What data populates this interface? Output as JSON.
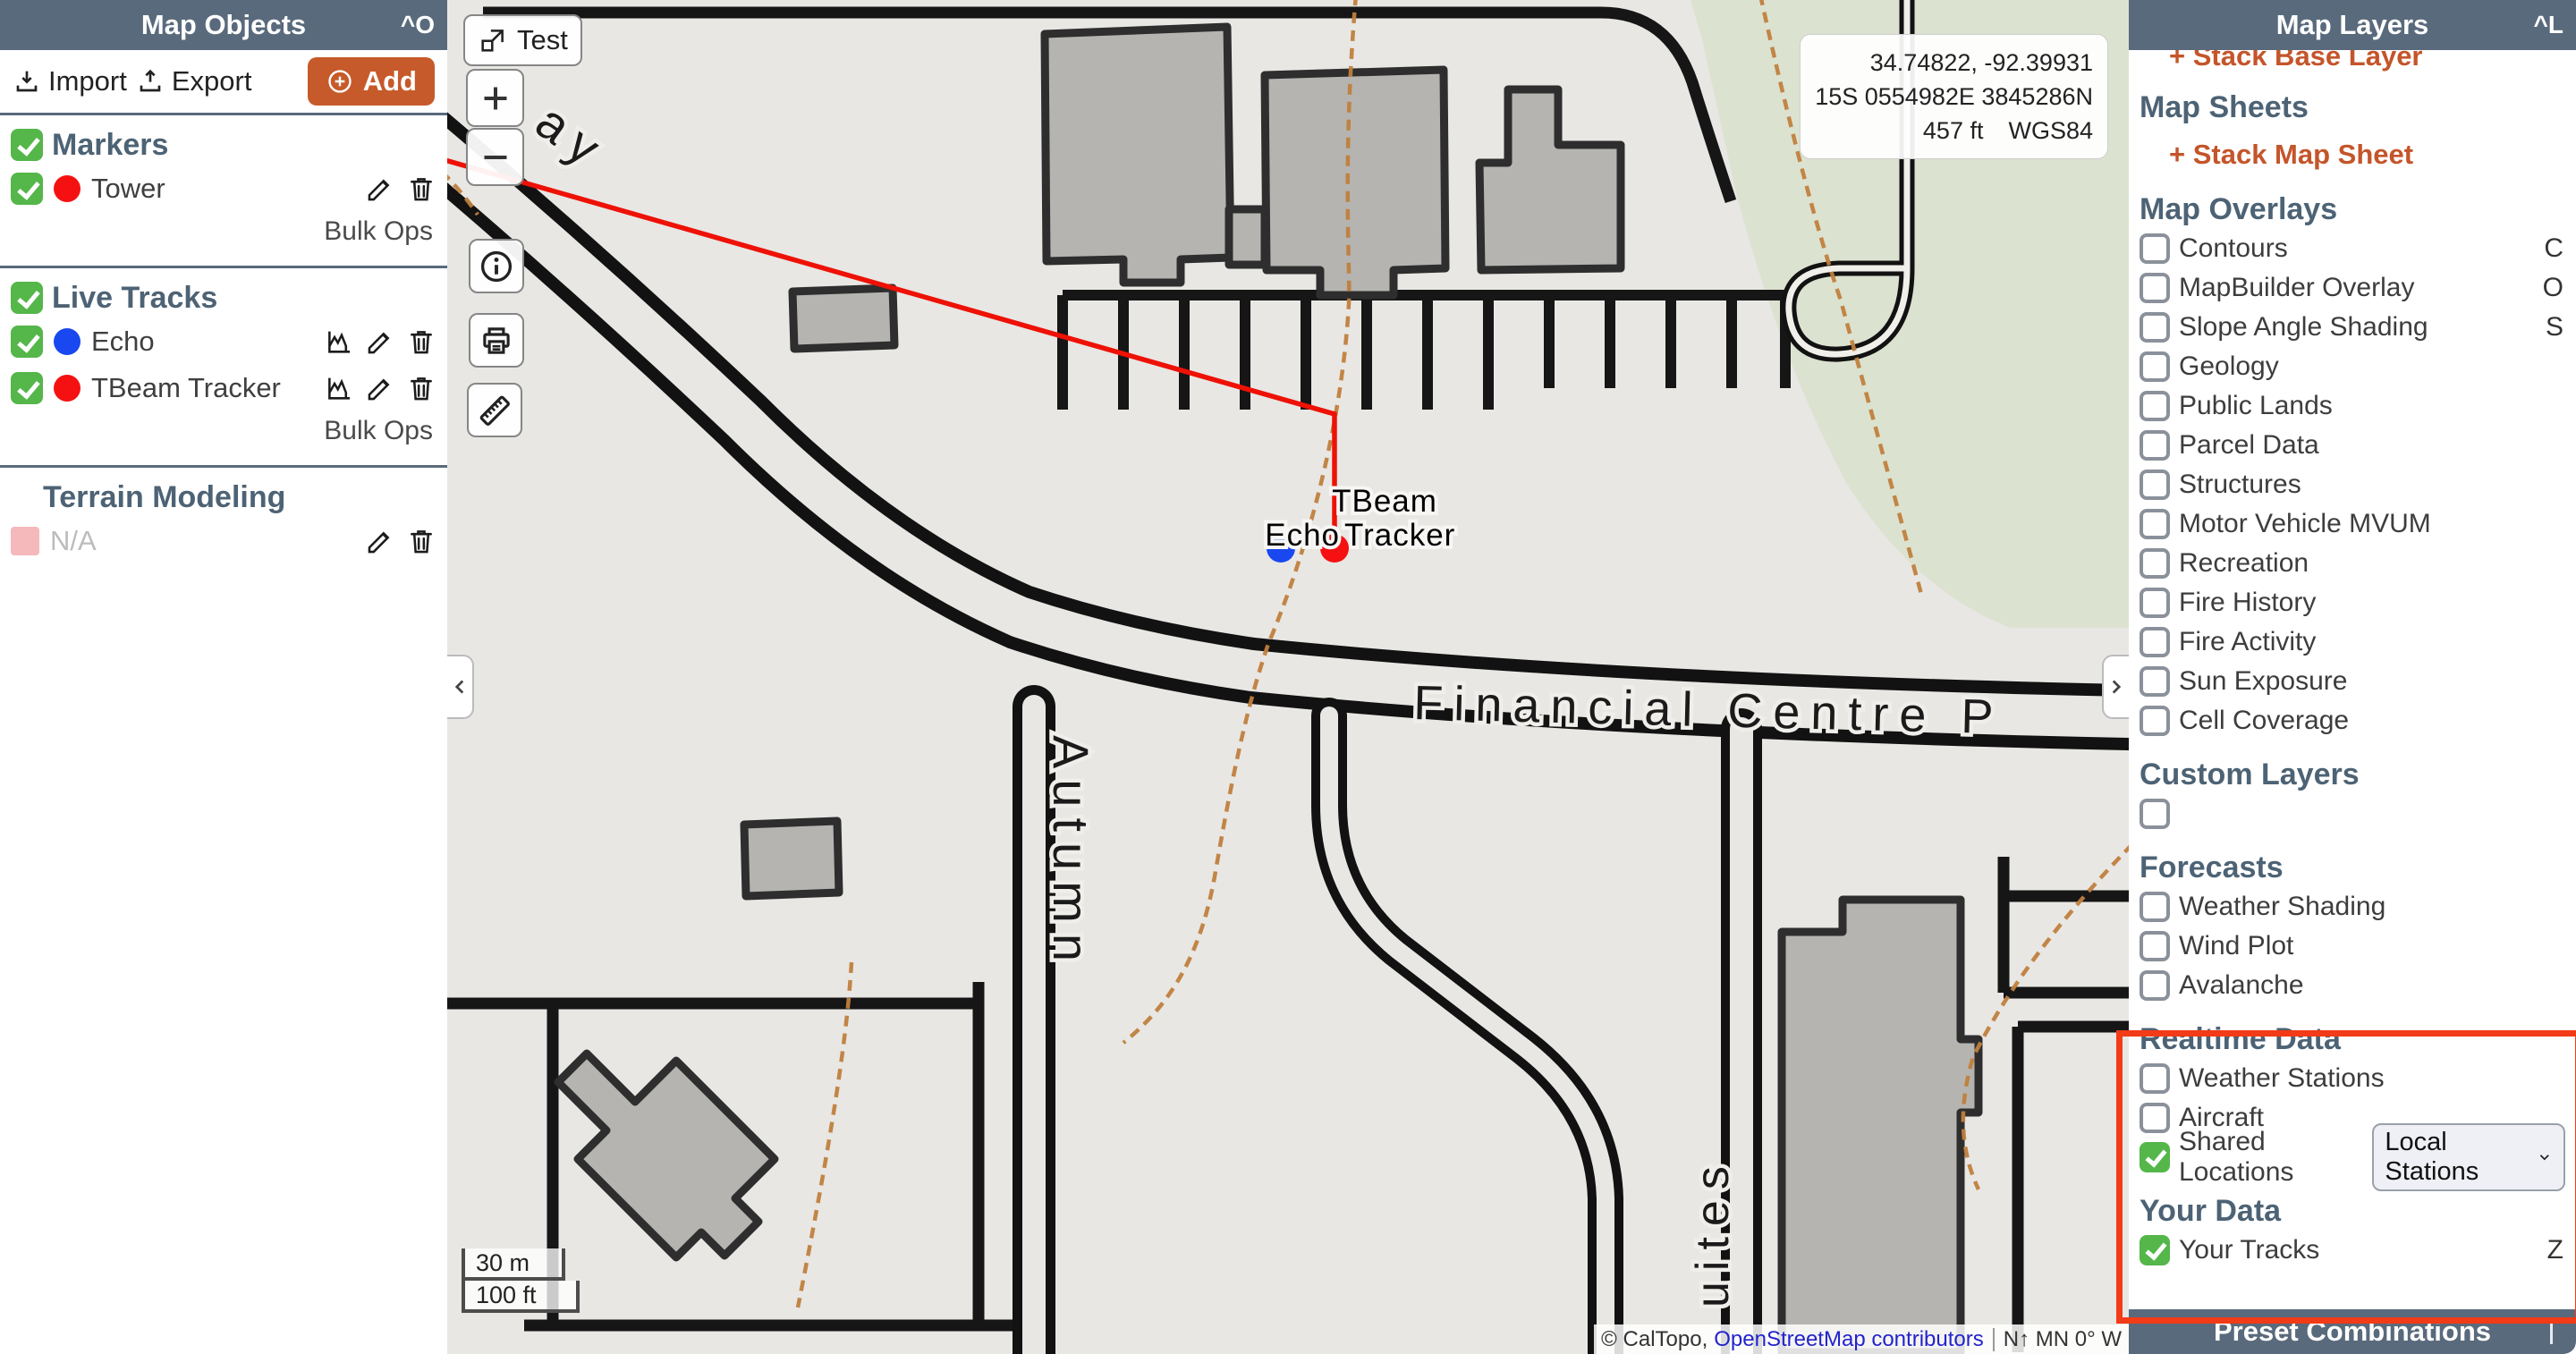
{
  "colors": {
    "header_slate": "#596a7c",
    "heading_slate": "#4d6375",
    "accent_orange": "#c65a2a",
    "checkbox_green": "#55b64a",
    "marker_red": "#f51111",
    "marker_blue": "#1948f0",
    "track_red": "#ee1105",
    "highlight_red": "#f23b17",
    "contour_orange": "#c0803d"
  },
  "left_panel": {
    "title": "Map Objects",
    "shortcut": "^O",
    "toolbar": {
      "import": "Import",
      "export": "Export",
      "add": "Add"
    },
    "sections": {
      "markers": {
        "label": "Markers",
        "items": [
          {
            "label": "Tower",
            "color": "#f51111",
            "checked": true
          }
        ],
        "bulk_ops": "Bulk Ops"
      },
      "live_tracks": {
        "label": "Live Tracks",
        "items": [
          {
            "label": "Echo",
            "color": "#1948f0",
            "checked": true
          },
          {
            "label": "TBeam Tracker",
            "color": "#f51111",
            "checked": true
          }
        ],
        "bulk_ops": "Bulk Ops"
      },
      "terrain": {
        "label": "Terrain Modeling",
        "items": [
          {
            "label": "N/A",
            "color": "#f5b8bb",
            "checked": false
          }
        ]
      }
    }
  },
  "map": {
    "test_button": "Test",
    "coordinates": {
      "latlon": "34.74822, -92.39931",
      "utm": "15S 0554982E 3845286N",
      "elevation": "457 ft",
      "datum": "WGS84"
    },
    "scale": {
      "metric": "30 m",
      "imperial": "100 ft"
    },
    "attribution": {
      "caltopo": "© CalTopo,",
      "osm": "OpenStreetMap contributors",
      "compass": "N↑ MN 0° W"
    },
    "street_labels": {
      "financial": "Financial Centre P",
      "autumn": "Autumn",
      "suites": "uites",
      "way": "ay"
    },
    "marker_labels": {
      "tbeam_line1": "TBeam",
      "tbeam_line2": "Tracker",
      "echo": "Echo"
    }
  },
  "right_panel": {
    "title": "Map Layers",
    "shortcut": "^L",
    "stack_base_layer": "+ Stack Base Layer",
    "map_sheets": {
      "heading": "Map Sheets",
      "stack_link": "+ Stack Map Sheet"
    },
    "map_overlays": {
      "heading": "Map Overlays",
      "items": [
        {
          "label": "Contours",
          "shortcut": "C",
          "checked": false
        },
        {
          "label": "MapBuilder Overlay",
          "shortcut": "O",
          "checked": false
        },
        {
          "label": "Slope Angle Shading",
          "shortcut": "S",
          "checked": false
        },
        {
          "label": "Geology",
          "checked": false
        },
        {
          "label": "Public Lands",
          "checked": false
        },
        {
          "label": "Parcel Data",
          "checked": false
        },
        {
          "label": "Structures",
          "checked": false
        },
        {
          "label": "Motor Vehicle MVUM",
          "checked": false
        },
        {
          "label": "Recreation",
          "checked": false
        },
        {
          "label": "Fire History",
          "checked": false
        },
        {
          "label": "Fire Activity",
          "checked": false
        },
        {
          "label": "Sun Exposure",
          "checked": false
        },
        {
          "label": "Cell Coverage",
          "checked": false
        }
      ]
    },
    "custom_layers": {
      "heading": "Custom Layers"
    },
    "forecasts": {
      "heading": "Forecasts",
      "items": [
        {
          "label": "Weather Shading",
          "checked": false
        },
        {
          "label": "Wind Plot",
          "checked": false
        },
        {
          "label": "Avalanche",
          "checked": false
        }
      ]
    },
    "realtime": {
      "heading": "Realtime Data",
      "items": [
        {
          "label": "Weather Stations",
          "checked": false
        },
        {
          "label": "Aircraft",
          "checked": false
        },
        {
          "label": "Shared Locations",
          "checked": true,
          "select_value": "Local Stations"
        }
      ]
    },
    "your_data": {
      "heading": "Your Data",
      "items": [
        {
          "label": "Your Tracks",
          "checked": true,
          "shortcut": "Z"
        }
      ]
    },
    "preset_combinations": "Preset Combinations"
  }
}
